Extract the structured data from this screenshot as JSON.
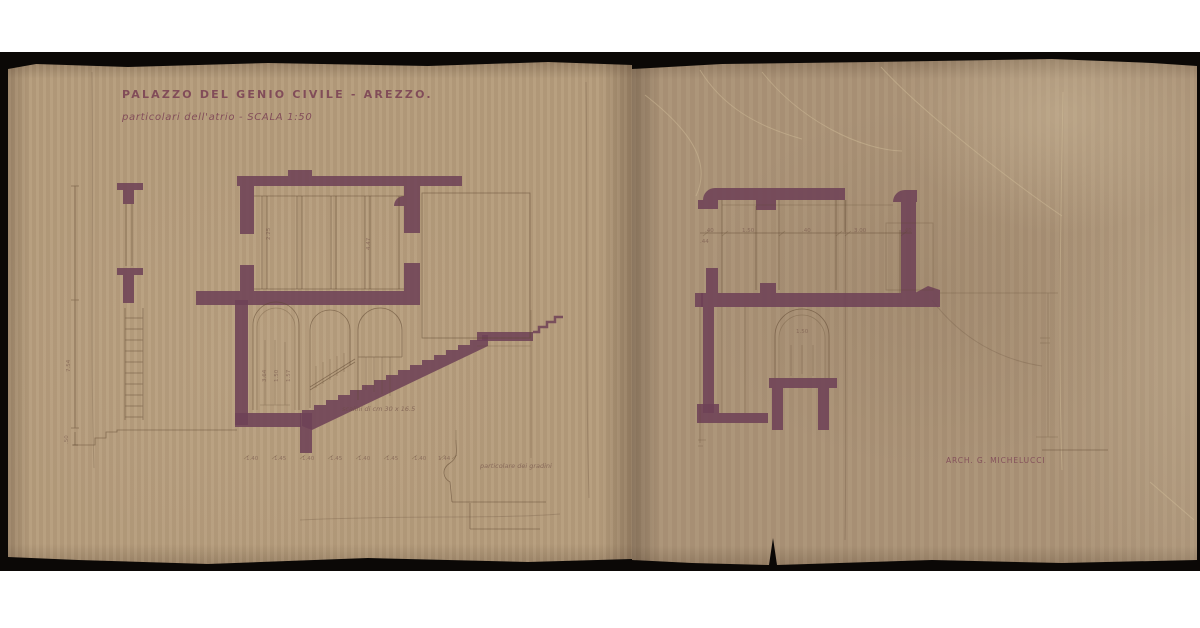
{
  "title": "PALAZZO DEL GENIO CIVILE - AREZZO.",
  "subtitle": "particolari dell'atrio - SCALA 1:50",
  "signature": "ARCH. G. MICHELUCCI",
  "left_drawing": {
    "stair_note": "scalini di cm 30 x 16.5",
    "step_detail_label": "particolare dei gradini",
    "height_dim": "7.54",
    "base_dim": ".50",
    "upper_dims": [
      "2.25",
      "4.47"
    ],
    "arch_dims": [
      "3.64",
      "1.50",
      "1.57"
    ],
    "bottom_dims": [
      "1.40",
      "1.45",
      "1.40",
      "1.45",
      "1.40",
      "1.45",
      "1.40",
      "1.44"
    ]
  },
  "right_drawing": {
    "top_dims": [
      ".40",
      "1.50",
      ".40",
      "3.00",
      ".40"
    ],
    "side_dim": ".44",
    "arch_dim": "1.50"
  },
  "colors": {
    "ink": "#6e4156",
    "ink_text": "#7e4656",
    "paper_left": "#b49b7b",
    "paper_right": "#aa9276",
    "backing": "#0b0806"
  }
}
